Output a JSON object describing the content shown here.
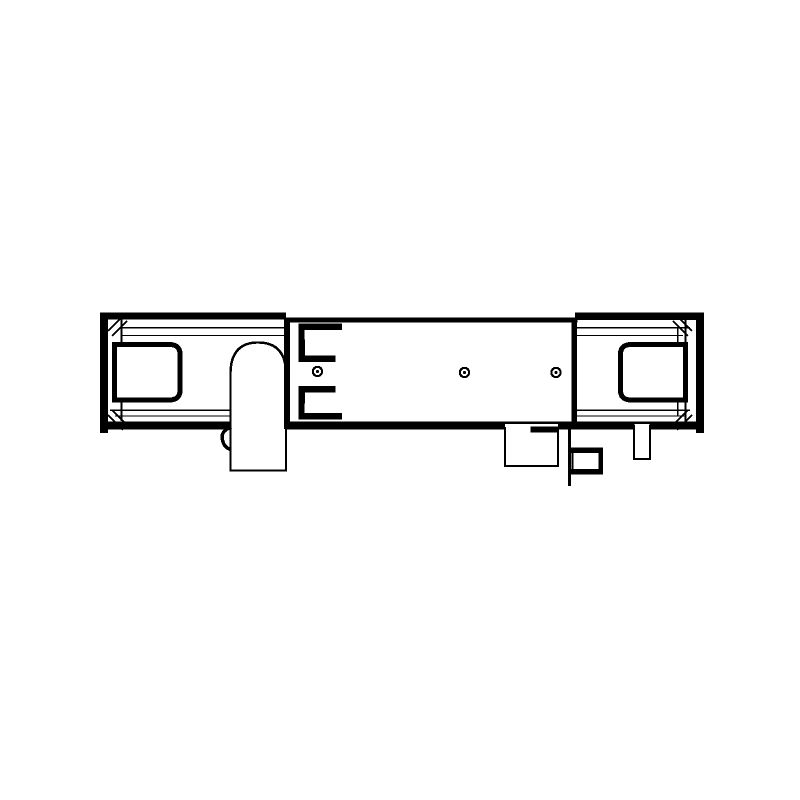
{
  "app": {
    "background": "#ffffff",
    "ink": "#000000",
    "description": "Black-and-white technical line drawing (front elevation) of an elongated wall-mounted fixture: rail body with heavy end caps, corner hatch marks, two rounded-square end windows, central mounting plate with two spring clips and three screw holes, a rounded lever handle, and small outlet/connector parts below the body."
  },
  "diagram": {
    "viewbox": "0 0 800 800",
    "shapes": [
      {
        "name": "body-outline",
        "tag": "rect",
        "attrs": {
          "x": 104,
          "y": 318.5,
          "width": 596,
          "height": 110,
          "fill": "#ffffff",
          "stroke": "#000000",
          "stroke-width": 2.2
        }
      },
      {
        "name": "left-top-rail-bar",
        "tag": "rect",
        "attrs": {
          "x": 100,
          "y": 312.5,
          "width": 186,
          "height": 7,
          "fill": "#000000"
        }
      },
      {
        "name": "right-top-rail-bar",
        "tag": "rect",
        "attrs": {
          "x": 575,
          "y": 312.5,
          "width": 129,
          "height": 7.5,
          "fill": "#000000"
        }
      },
      {
        "name": "bottom-rail-bar",
        "tag": "rect",
        "attrs": {
          "x": 100,
          "y": 421.5,
          "width": 604,
          "height": 7.5,
          "fill": "#000000"
        }
      },
      {
        "name": "end-cap-left",
        "tag": "rect",
        "attrs": {
          "x": 100,
          "y": 312.5,
          "width": 8,
          "height": 120.5,
          "fill": "#000000"
        }
      },
      {
        "name": "end-cap-right",
        "tag": "rect",
        "attrs": {
          "x": 696,
          "y": 312.5,
          "width": 8,
          "height": 120.5,
          "fill": "#000000"
        }
      },
      {
        "name": "left-inner-vertical",
        "tag": "line",
        "attrs": {
          "x1": 121.5,
          "y1": 319,
          "x2": 121.5,
          "y2": 421,
          "stroke": "#000000",
          "stroke-width": 2
        }
      },
      {
        "name": "right-inner-vertical",
        "tag": "line",
        "attrs": {
          "x1": 685.5,
          "y1": 319,
          "x2": 685.5,
          "y2": 421,
          "stroke": "#000000",
          "stroke-width": 2.2
        }
      },
      {
        "name": "right-inner-vertical-2",
        "tag": "line",
        "attrs": {
          "x1": 677.5,
          "y1": 327,
          "x2": 677.5,
          "y2": 416,
          "stroke": "#000000",
          "stroke-width": 1.5
        }
      },
      {
        "name": "left-top-line-1",
        "tag": "line",
        "attrs": {
          "x1": 121.5,
          "y1": 327.5,
          "x2": 284,
          "y2": 327.5,
          "stroke": "#000000",
          "stroke-width": 1.5
        }
      },
      {
        "name": "left-top-line-2",
        "tag": "line",
        "attrs": {
          "x1": 121.5,
          "y1": 335.5,
          "x2": 284,
          "y2": 335.5,
          "stroke": "#000000",
          "stroke-width": 1.4
        }
      },
      {
        "name": "right-top-line-1",
        "tag": "line",
        "attrs": {
          "x1": 577,
          "y1": 327.5,
          "x2": 690,
          "y2": 327.5,
          "stroke": "#000000",
          "stroke-width": 1.5
        }
      },
      {
        "name": "right-top-line-2",
        "tag": "line",
        "attrs": {
          "x1": 577,
          "y1": 335.5,
          "x2": 683,
          "y2": 335.5,
          "stroke": "#000000",
          "stroke-width": 1.4
        }
      },
      {
        "name": "left-bottom-line-1",
        "tag": "line",
        "attrs": {
          "x1": 110,
          "y1": 410,
          "x2": 284,
          "y2": 410,
          "stroke": "#000000",
          "stroke-width": 1.5
        }
      },
      {
        "name": "left-bottom-line-2",
        "tag": "line",
        "attrs": {
          "x1": 115,
          "y1": 416,
          "x2": 284,
          "y2": 416,
          "stroke": "#000000",
          "stroke-width": 1.4
        }
      },
      {
        "name": "right-bottom-line-1",
        "tag": "line",
        "attrs": {
          "x1": 577,
          "y1": 410,
          "x2": 690,
          "y2": 410,
          "stroke": "#000000",
          "stroke-width": 1.5
        }
      },
      {
        "name": "right-bottom-line-2",
        "tag": "line",
        "attrs": {
          "x1": 577,
          "y1": 416,
          "x2": 685,
          "y2": 416,
          "stroke": "#000000",
          "stroke-width": 1.4
        }
      },
      {
        "name": "corner-hatch-tl-1",
        "tag": "line",
        "attrs": {
          "x1": 108,
          "y1": 331,
          "x2": 123,
          "y2": 316,
          "stroke": "#000000",
          "stroke-width": 2
        }
      },
      {
        "name": "corner-hatch-tl-2",
        "tag": "line",
        "attrs": {
          "x1": 112,
          "y1": 336,
          "x2": 127,
          "y2": 321,
          "stroke": "#000000",
          "stroke-width": 2
        }
      },
      {
        "name": "corner-hatch-tr-1",
        "tag": "line",
        "attrs": {
          "x1": 677,
          "y1": 316,
          "x2": 692,
          "y2": 331,
          "stroke": "#000000",
          "stroke-width": 2
        }
      },
      {
        "name": "corner-hatch-tr-2",
        "tag": "line",
        "attrs": {
          "x1": 673,
          "y1": 321,
          "x2": 688,
          "y2": 336,
          "stroke": "#000000",
          "stroke-width": 2
        }
      },
      {
        "name": "corner-hatch-bl-1",
        "tag": "line",
        "attrs": {
          "x1": 108,
          "y1": 415,
          "x2": 123,
          "y2": 430,
          "stroke": "#000000",
          "stroke-width": 2
        }
      },
      {
        "name": "corner-hatch-bl-2",
        "tag": "line",
        "attrs": {
          "x1": 112,
          "y1": 410,
          "x2": 127,
          "y2": 425,
          "stroke": "#000000",
          "stroke-width": 2
        }
      },
      {
        "name": "corner-hatch-br-1",
        "tag": "line",
        "attrs": {
          "x1": 677,
          "y1": 430,
          "x2": 692,
          "y2": 415,
          "stroke": "#000000",
          "stroke-width": 2
        }
      },
      {
        "name": "corner-hatch-br-2",
        "tag": "line",
        "attrs": {
          "x1": 673,
          "y1": 425,
          "x2": 688,
          "y2": 410,
          "stroke": "#000000",
          "stroke-width": 2
        }
      },
      {
        "name": "handle-lever",
        "tag": "path",
        "attrs": {
          "d": "M230.5,470.5 V374 Q230.5,342.5 258,342.5 Q286,342.5 286,374 V470.5 Z",
          "fill": "#ffffff",
          "stroke": "#000000",
          "stroke-width": 2.4
        }
      },
      {
        "name": "handle-grip-bump",
        "tag": "path",
        "attrs": {
          "d": "M231.5,427.5 C223,429.5 221,435 222.5,440 C224,446.5 227.5,449 231.5,449.5",
          "fill": "none",
          "stroke": "#000000",
          "stroke-width": 3.4
        }
      },
      {
        "name": "mounting-plate",
        "tag": "rect",
        "attrs": {
          "x": 287,
          "y": 320.5,
          "width": 289,
          "height": 104,
          "fill": "#ffffff",
          "stroke": "#000000",
          "stroke-width": 2
        }
      },
      {
        "name": "plate-left-edge",
        "tag": "rect",
        "attrs": {
          "x": 284,
          "y": 318.5,
          "width": 6,
          "height": 110.5,
          "fill": "#000000"
        }
      },
      {
        "name": "plate-top-edge",
        "tag": "rect",
        "attrs": {
          "x": 284,
          "y": 318.5,
          "width": 293.5,
          "height": 4.2,
          "fill": "#000000"
        }
      },
      {
        "name": "plate-bottom-edge",
        "tag": "rect",
        "attrs": {
          "x": 284,
          "y": 421.5,
          "width": 293.5,
          "height": 7.2,
          "fill": "#000000"
        }
      },
      {
        "name": "plate-right-edge",
        "tag": "rect",
        "attrs": {
          "x": 571.5,
          "y": 318.5,
          "width": 4.5,
          "height": 110.5,
          "fill": "#000000"
        }
      },
      {
        "name": "left-window",
        "tag": "path",
        "attrs": {
          "d": "M114.5,344.5 H169 Q180,344.5 180,354 V390.5 Q180,400 169,400 H114.5 Z",
          "fill": "#ffffff",
          "stroke": "#000000",
          "stroke-width": 5
        }
      },
      {
        "name": "right-window",
        "tag": "path",
        "attrs": {
          "d": "M685.5,344.5 H631.5 Q620.5,344.5 620.5,354 V390.5 Q620.5,400 631.5,400 H685.5 Z",
          "fill": "#ffffff",
          "stroke": "#000000",
          "stroke-width": 5
        }
      },
      {
        "name": "upper-spring-clip",
        "tag": "path",
        "attrs": {
          "d": "M342,326.5 H301.5 V358.5 H335.5",
          "fill": "none",
          "stroke": "#000000",
          "stroke-width": 6.5
        }
      },
      {
        "name": "upper-clip-notch",
        "tag": "rect",
        "attrs": {
          "x": 304.5,
          "y": 330,
          "width": 4.5,
          "height": 9.5,
          "fill": "#ffffff"
        }
      },
      {
        "name": "lower-spring-clip",
        "tag": "path",
        "attrs": {
          "d": "M335.5,389 H301.5 V416 H342",
          "fill": "none",
          "stroke": "#000000",
          "stroke-width": 6.5
        }
      },
      {
        "name": "lower-clip-notch",
        "tag": "rect",
        "attrs": {
          "x": 304.5,
          "y": 403.5,
          "width": 4.5,
          "height": 9.5,
          "fill": "#ffffff"
        }
      },
      {
        "name": "screw-hole-left",
        "tag": "circle",
        "attrs": {
          "cx": 317.5,
          "cy": 371.5,
          "r": 4.6,
          "fill": "#ffffff",
          "stroke": "#000000",
          "stroke-width": 2.2
        }
      },
      {
        "name": "screw-hole-left-dot",
        "tag": "circle",
        "attrs": {
          "cx": 317.5,
          "cy": 371.5,
          "r": 1.5,
          "fill": "#000000"
        }
      },
      {
        "name": "screw-hole-center",
        "tag": "circle",
        "attrs": {
          "cx": 464.5,
          "cy": 372.5,
          "r": 4.6,
          "fill": "#ffffff",
          "stroke": "#000000",
          "stroke-width": 2.2
        }
      },
      {
        "name": "screw-hole-center-dot",
        "tag": "circle",
        "attrs": {
          "cx": 464.5,
          "cy": 372.5,
          "r": 1.5,
          "fill": "#000000"
        }
      },
      {
        "name": "screw-hole-right",
        "tag": "circle",
        "attrs": {
          "cx": 556,
          "cy": 372.5,
          "r": 4.6,
          "fill": "#ffffff",
          "stroke": "#000000",
          "stroke-width": 2.2
        }
      },
      {
        "name": "screw-hole-right-dot",
        "tag": "circle",
        "attrs": {
          "cx": 556,
          "cy": 372.5,
          "r": 1.5,
          "fill": "#000000"
        }
      },
      {
        "name": "outlet-box-fill",
        "tag": "rect",
        "attrs": {
          "x": 505,
          "y": 424,
          "width": 53,
          "height": 42,
          "fill": "#ffffff"
        }
      },
      {
        "name": "outlet-box-outline",
        "tag": "path",
        "attrs": {
          "d": "M505,427 V466 H558 V427",
          "fill": "none",
          "stroke": "#000000",
          "stroke-width": 2
        }
      },
      {
        "name": "outlet-box-top-edge",
        "tag": "rect",
        "attrs": {
          "x": 530.5,
          "y": 426.5,
          "width": 27.5,
          "height": 6,
          "fill": "#000000"
        }
      },
      {
        "name": "bracket-drop-line",
        "tag": "line",
        "attrs": {
          "x1": 569.5,
          "y1": 429,
          "x2": 569.5,
          "y2": 486,
          "stroke": "#000000",
          "stroke-width": 2.6
        }
      },
      {
        "name": "connector-box",
        "tag": "rect",
        "attrs": {
          "x": 572.5,
          "y": 450.5,
          "width": 27.5,
          "height": 20.5,
          "fill": "#ffffff",
          "stroke": "#000000",
          "stroke-width": 2
        }
      },
      {
        "name": "connector-box-top-edge",
        "tag": "rect",
        "attrs": {
          "x": 569.5,
          "y": 447.5,
          "width": 33.5,
          "height": 5.5,
          "fill": "#000000"
        }
      },
      {
        "name": "connector-box-bottom-edge",
        "tag": "rect",
        "attrs": {
          "x": 569.5,
          "y": 469,
          "width": 33.5,
          "height": 5.5,
          "fill": "#000000"
        }
      },
      {
        "name": "connector-box-right-edge",
        "tag": "rect",
        "attrs": {
          "x": 598.5,
          "y": 447.5,
          "width": 4.5,
          "height": 27,
          "fill": "#000000"
        }
      },
      {
        "name": "drain-stub-fill",
        "tag": "rect",
        "attrs": {
          "x": 634,
          "y": 424,
          "width": 16,
          "height": 35,
          "fill": "#ffffff"
        }
      },
      {
        "name": "drain-stub-outline",
        "tag": "path",
        "attrs": {
          "d": "M634,424.5 V459 H650 V424.5",
          "fill": "none",
          "stroke": "#000000",
          "stroke-width": 2.2
        }
      }
    ]
  }
}
